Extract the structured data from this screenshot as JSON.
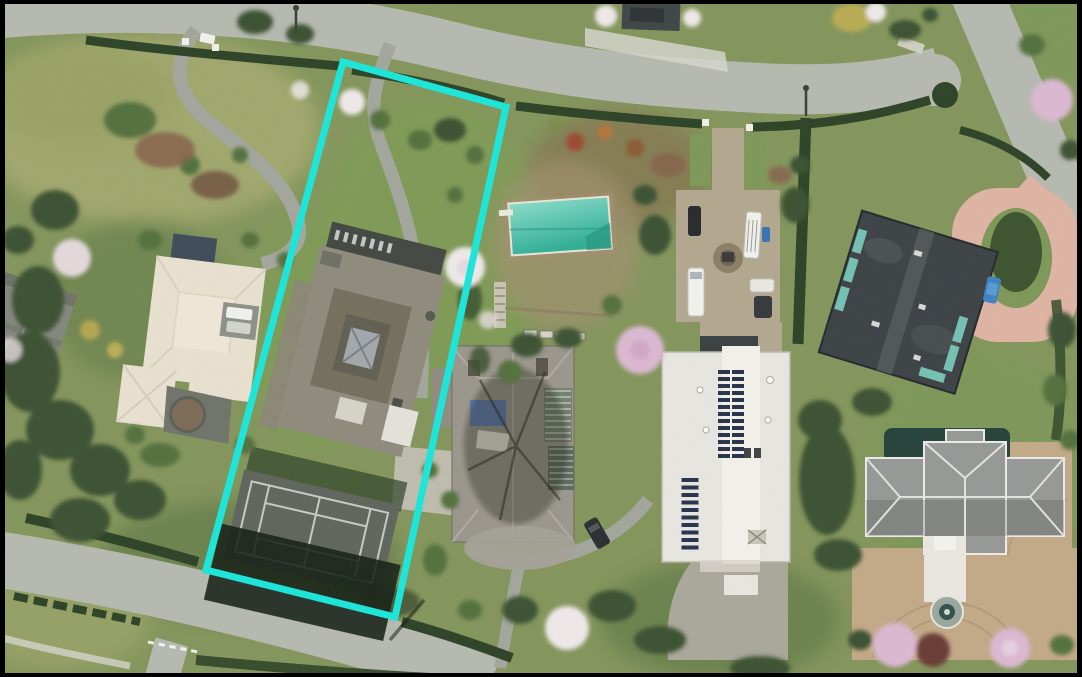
{
  "image": {
    "kind": "aerial-satellite-photo",
    "annotation": {
      "name": "highlighted-property-boundary",
      "shape": "rotated-rectangle",
      "color": "#1fe4d8"
    },
    "features": [
      "top-street",
      "diagonal-street",
      "bottom-street",
      "winding-driveway",
      "highlighted-lot-driveway",
      "motor-court",
      "pink-loop-driveway",
      "tan-courtyard",
      "highlighted-lot-house",
      "tennis-court",
      "left-cream-house",
      "far-left-house",
      "middle-hip-roof-house",
      "solar-panel-house",
      "dark-flat-roof-house",
      "fountain-house",
      "swimming-pool",
      "pool-patio",
      "fountain",
      "white-van",
      "white-cars",
      "dark-cars",
      "blue-car",
      "hedges",
      "blossom-trees",
      "evergreen-trees",
      "lawns"
    ]
  },
  "palette": {
    "grassMid": "#83955b",
    "grassDry": "#a4a96e",
    "grassDry2": "#99a265",
    "grassBright": "#7e9c55",
    "grassMid2": "#7d9758",
    "grassDark": "#55703f",
    "road": "#b6b9b0",
    "roadPale": "#c6c8be",
    "paleConcrete": "#d6d5cb",
    "drive": "#a3a69c",
    "drive2": "#aaa79b",
    "drivePale": "#c2bfb2",
    "court": "#b2a88e",
    "courtRing": "#8a7f66",
    "pinkDrive": "#dfb4a4",
    "tan": "#c3a987",
    "tanDark": "#a88f72",
    "hedge": "#2c4226",
    "treeDark": "#3a5130",
    "treeMid": "#52703e",
    "mulch": "#86604a",
    "mulchDark": "#6d4d3c",
    "roofGray2": "#84877e",
    "roofCream": "#e9e1d0",
    "roofBrown": "#7d5c49",
    "roofBlue": "#3d4a5a",
    "roofTan": "#8f8b7c",
    "roofMid": "#9a968b",
    "roofWhite": "#e8e6e0",
    "roofDark": "#3c4145",
    "roofGrayLight": "#969897",
    "teal": "#74c0b4",
    "tennis": "#5f645c",
    "tennisLine": "#d2d6cf",
    "poolTop": "#8adcca",
    "poolBottom": "#2fae95",
    "patio": "#a3906f",
    "tarp": "#5c79b4",
    "solar": "#26324b",
    "carWhite": "#f1f1ee",
    "carBlue": "#3f82c0",
    "highlight": "#1fe4d8",
    "frame": "#000000"
  }
}
